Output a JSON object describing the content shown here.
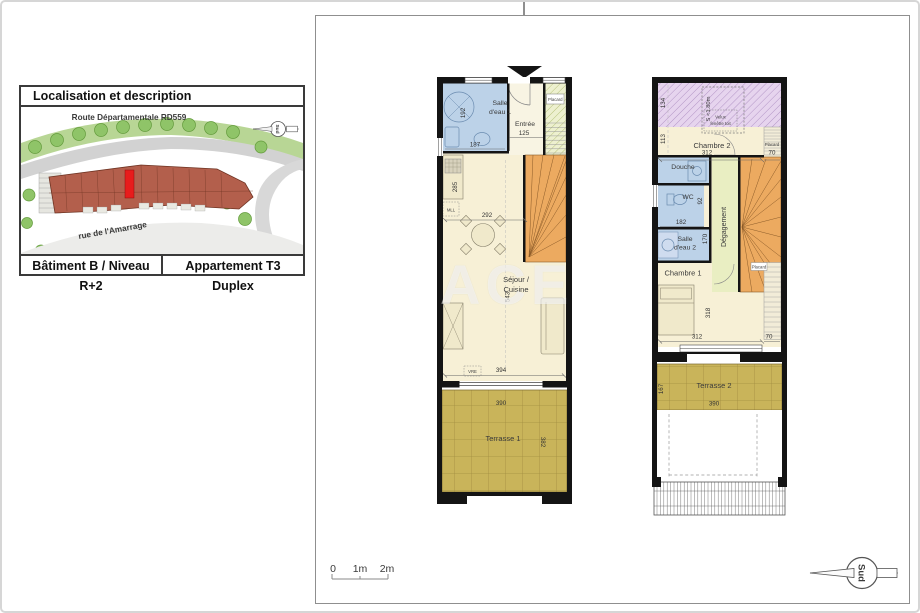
{
  "loc": {
    "title": "Localisation et description",
    "map": {
      "road": "Route Départamentale RD559",
      "street": "rue de l'Amarrage",
      "compass": "Sud"
    },
    "footer": {
      "building": "Bâtiment B / Niveau R+2",
      "apartment": "Appartement T3 Duplex"
    }
  },
  "watermark": {
    "text": "ACE"
  },
  "plan1": {
    "salle_eau1": {
      "l1": "Salle",
      "l2": "d'eau 1",
      "d_h": "192",
      "d_w": "187"
    },
    "entree": {
      "label": "Entrée",
      "dim": "125"
    },
    "placard": {
      "label": "Placard"
    },
    "sejour": {
      "l1": "Séjour /",
      "l2": "Cuisine",
      "d285": "285",
      "d292": "292",
      "d543": "543",
      "d394": "394",
      "mll": "MLL",
      "vre": "VRE"
    },
    "terrasse": {
      "label": "Terrasse 1",
      "d_w": "390",
      "d_h": "382"
    }
  },
  "plan2": {
    "attic": {
      "label": "S <1.80m",
      "d134": "134",
      "d113": "113",
      "velux1": "Velux",
      "velux2": "fenêtre toit"
    },
    "chambre2": {
      "label": "Chambre 2",
      "d_w": "312",
      "placard": "Placard",
      "d_pl": "70"
    },
    "douche": {
      "label": "Douche"
    },
    "wc": {
      "label": "WC",
      "dim": "92"
    },
    "d182": "182",
    "salle_eau2": {
      "l1": "Salle",
      "l2": "d'eau 2",
      "dim": "170"
    },
    "degagement": {
      "label": "Dégagement"
    },
    "chambre1": {
      "label": "Chambre 1",
      "d_h": "318",
      "d_w": "312",
      "placard": "Placard",
      "d_pl": "70"
    },
    "terrasse": {
      "label": "Terrasse 2",
      "d_h": "167",
      "d_w": "390"
    }
  },
  "scale": {
    "t0": "0",
    "t1": "1m",
    "t2": "2m"
  },
  "compass": {
    "label": "Sud"
  },
  "colors": {
    "wall": "#141414",
    "wet_room": "#bcd2e8",
    "living": "#f7f0d6",
    "attic": "#e6d4ee",
    "corridor": "#e9eec2",
    "stairs": "#ecaa60",
    "terrace": "#c9b45a",
    "marker_red": "#e81c1c",
    "map_green": "#b8d695"
  }
}
